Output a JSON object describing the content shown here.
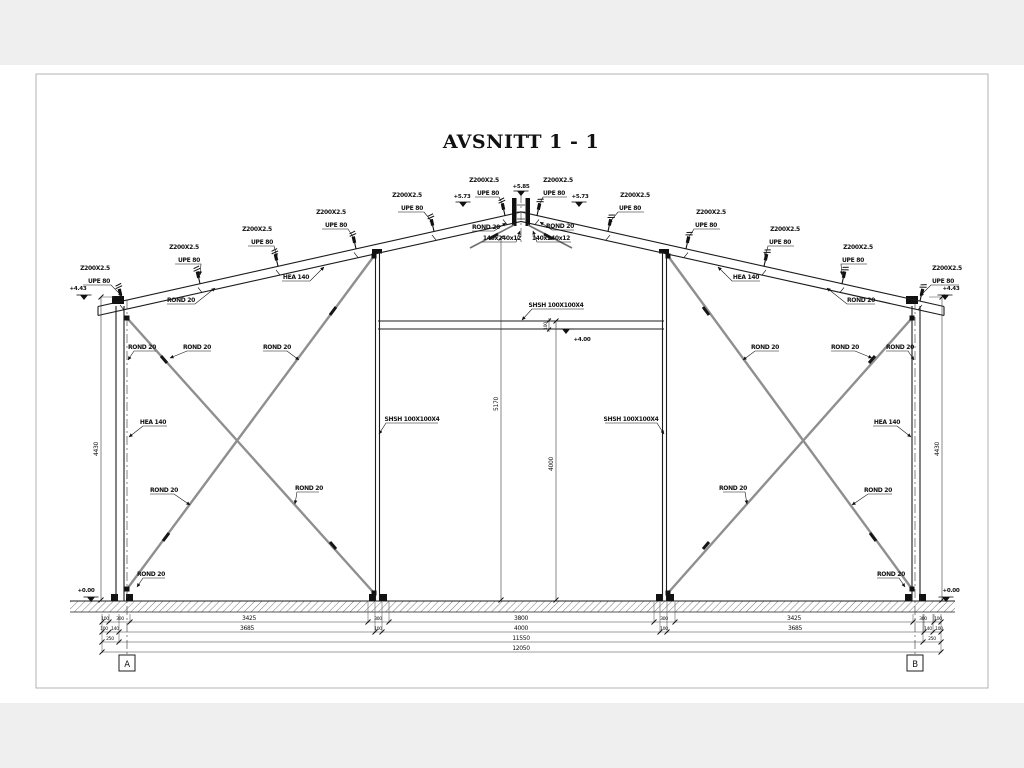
{
  "page": {
    "title": "AVSNITT 1 - 1"
  },
  "grid": {
    "a": "A",
    "b": "B"
  },
  "labels": {
    "purlin_z": "Z200X2.5",
    "purlin_upe": "UPE 80",
    "rod": "ROND 20",
    "column": "HEA 140",
    "shs": "SHSH 100X100X4",
    "plate_left": "140x240x12",
    "plate_right": "140x240x12"
  },
  "levels": {
    "ridge": "+5.85",
    "roof_left": "+5.73",
    "roof_right": "+5.73",
    "eave_left": "+4.43",
    "eave_right": "+4.43",
    "header": "+4.00",
    "base_left": "+0.00",
    "base_right": "+0.00"
  },
  "dims": {
    "row1": [
      "100",
      "300",
      "3425",
      "300",
      "3800",
      "300",
      "3425",
      "300",
      "100"
    ],
    "row2": [
      "100",
      "140",
      "3685",
      "100",
      "4000",
      "100",
      "3685",
      "140",
      "100"
    ],
    "row3": [
      "250",
      "11550",
      "250"
    ],
    "row4": [
      "12050"
    ],
    "eave_height_left": "4430",
    "eave_height_right": "4430",
    "ridge_height": "5170",
    "door_height": "4000",
    "header_depth": "100"
  }
}
